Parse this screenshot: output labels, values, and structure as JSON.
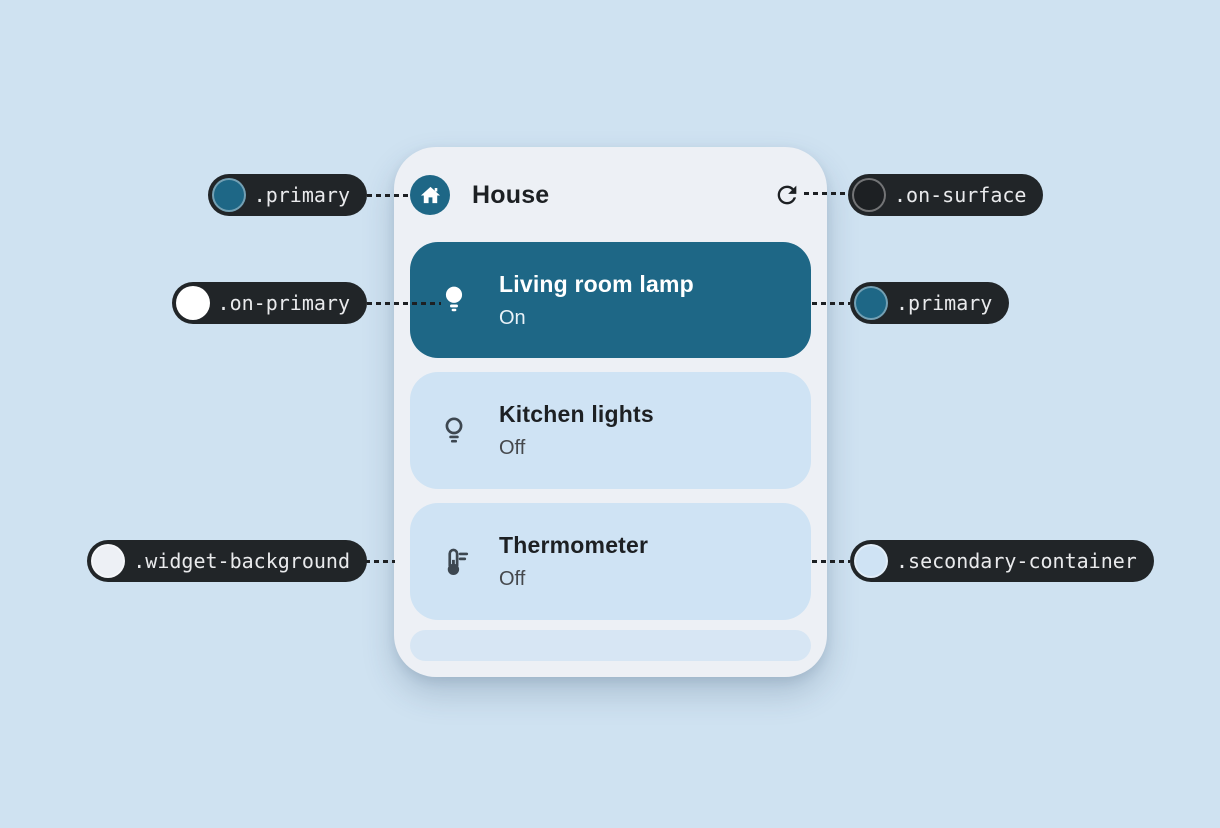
{
  "colors": {
    "page_bg": "#cfe2f1",
    "widget_bg": "#edf0f5",
    "primary": "#1e6786",
    "on_primary": "#ffffff",
    "secondary_container": "#cfe3f4",
    "bottom_pill": "#d7e6f4",
    "on_surface": "#1d2023",
    "status_off": "#45484c",
    "icon": "#3d4750",
    "callout_bg": "#212528",
    "callout_text": "#e9eaec",
    "connector": "#1d2023"
  },
  "widget": {
    "title": "House",
    "devices": [
      {
        "name": "Living room lamp",
        "status": "On"
      },
      {
        "name": "Kitchen lights",
        "status": "Off"
      },
      {
        "name": "Thermometer",
        "status": "Off"
      }
    ]
  },
  "callouts": {
    "primary_header": {
      "label": ".primary",
      "swatch": "#1e6786"
    },
    "on_surface": {
      "label": ".on-surface",
      "swatch": "#1d2023"
    },
    "on_primary": {
      "label": ".on-primary",
      "swatch": "#ffffff"
    },
    "primary_card": {
      "label": ".primary",
      "swatch": "#1e6786"
    },
    "widget_background": {
      "label": ".widget-background",
      "swatch": "#edf0f5"
    },
    "secondary_container": {
      "label": ".secondary-container",
      "swatch": "#cfe3f4"
    }
  }
}
